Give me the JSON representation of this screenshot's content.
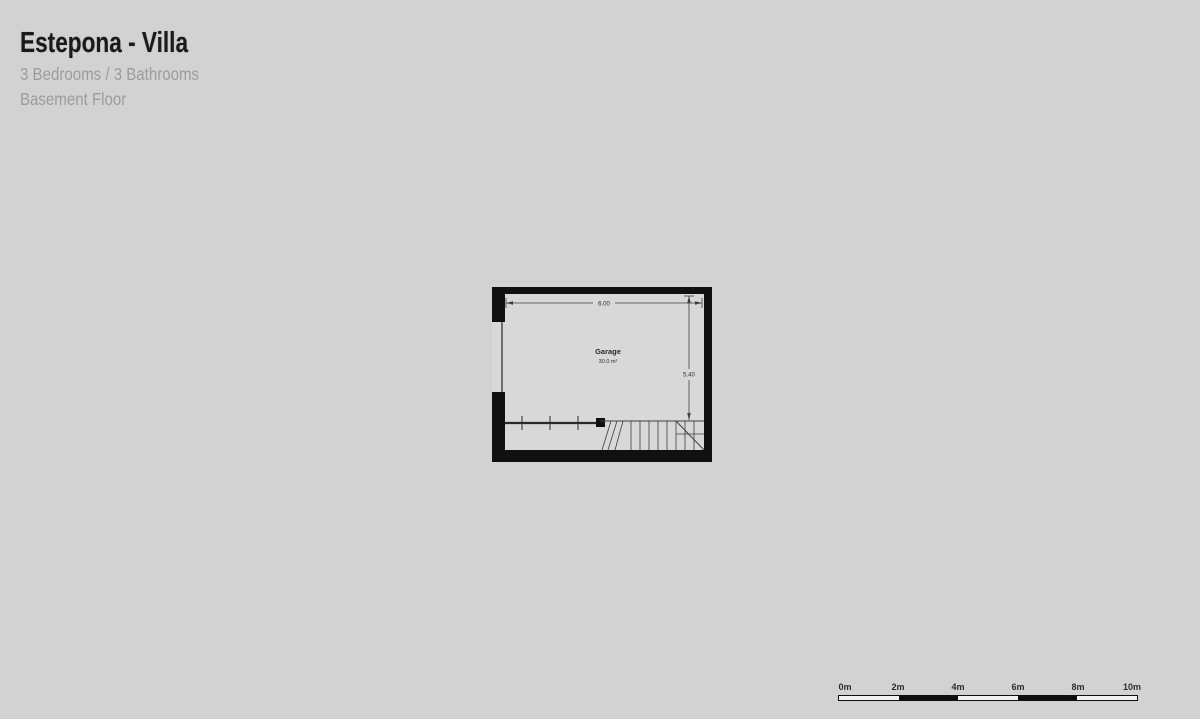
{
  "header": {
    "title": "Estepona - Villa",
    "subtitle": "3 Bedrooms / 3 Bathrooms",
    "floor_label": "Basement Floor"
  },
  "floor_plan": {
    "room_name": "Garage",
    "room_area": "30.0 m²",
    "dim_width": "6.00",
    "dim_height": "5.40"
  },
  "scale_bar": {
    "labels": [
      "0m",
      "2m",
      "4m",
      "6m",
      "8m",
      "10m"
    ]
  },
  "colors": {
    "background": "#d2d2d2",
    "plan_interior": "#d8d8d8",
    "wall": "#101010",
    "line": "#3f3f3f",
    "title_text": "#1a1a1a",
    "muted_text": "#9c9c9c"
  }
}
